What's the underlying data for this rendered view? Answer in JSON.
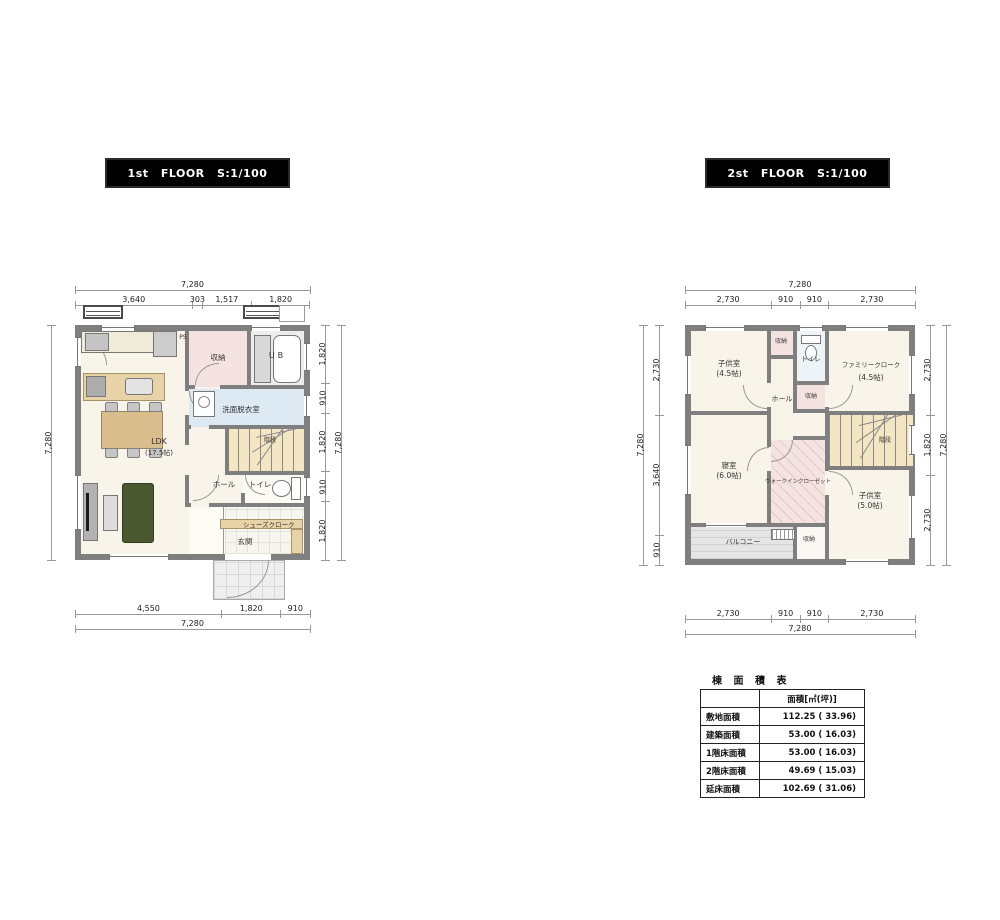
{
  "f1": {
    "title": "1st FLOOR S:1/100",
    "dims": {
      "total": "7,280",
      "top": [
        "3,640",
        "303",
        "1,517",
        "1,820"
      ],
      "right": [
        "1,820",
        "910",
        "1,820",
        "910",
        "1,820"
      ],
      "bottom": [
        "4,550",
        "1,820",
        "910"
      ]
    },
    "labels": {
      "ldk": "LDK",
      "ldk_size": "(17.5帖)",
      "ps": "PS",
      "storage": "収納",
      "ub": "UB",
      "washroom": "洗面脱衣室",
      "stairs": "階段",
      "hall": "ホール",
      "toilet": "トイレ",
      "shoes": "シューズクローク",
      "entrance": "玄関"
    }
  },
  "f2": {
    "title": "2st FLOOR S:1/100",
    "dims": {
      "total": "7,280",
      "top": [
        "2,730",
        "910",
        "910",
        "2,730"
      ],
      "left": [
        "2,730",
        "3,640",
        "910"
      ],
      "right": [
        "2,730",
        "1,820",
        "2,730"
      ],
      "bottom": [
        "2,730",
        "910",
        "910",
        "2,730"
      ]
    },
    "labels": {
      "kids1": "子供室",
      "kids1_size": "(4.5帖)",
      "family_closet": "ファミリークローク",
      "family_closet_size": "(4.5帖)",
      "storage_a": "収納",
      "toilet": "トイレ",
      "hall": "ホール",
      "storage_b": "収納",
      "bedroom": "寝室",
      "bedroom_size": "(6.0帖)",
      "wic": "ウォークインクローゼット",
      "kids2": "子供室",
      "kids2_size": "(5.0帖)",
      "storage_c": "収納",
      "balcony": "バルコニー",
      "stairs": "階段"
    }
  },
  "table": {
    "title": "棟 面 積 表",
    "header": "面積[㎡(坪)]",
    "rows": [
      {
        "label": "敷地面積",
        "value": "112.25 ( 33.96)"
      },
      {
        "label": "建築面積",
        "value": "53.00 ( 16.03)"
      },
      {
        "label": "1階床面積",
        "value": "53.00 ( 16.03)"
      },
      {
        "label": "2階床面積",
        "value": "49.69 ( 15.03)"
      },
      {
        "label": "延床面積",
        "value": "102.69 ( 31.06)"
      }
    ]
  },
  "colors": {
    "wall": "#7f7f7f",
    "floor": "#f9f4e9",
    "storage_pink": "#f5e3e1",
    "wet_blue": "#dde9f3",
    "stairs_tan": "#f4e5c3",
    "balcony_gray": "#e5e5e5",
    "wood": "#d9bd8d",
    "sofa_green": "#49582f",
    "title_bg": "#000000",
    "title_fg": "#ffffff"
  }
}
